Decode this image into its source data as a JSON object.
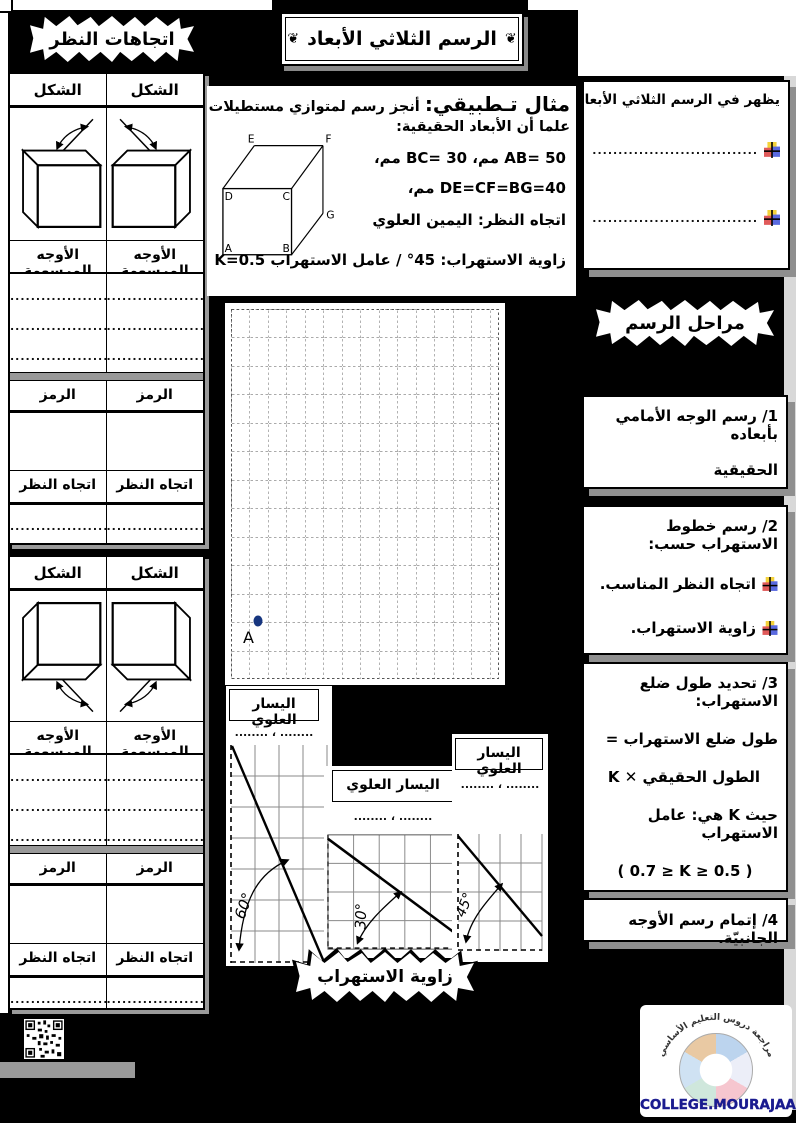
{
  "page": {
    "title": "الرسم الثلاثي الأبعاد",
    "ornament": "❦"
  },
  "view_directions": {
    "header": "اتجاهات النظر",
    "shape_header": "الشكل",
    "faces_header": "الأوجه المرسومة",
    "symbol_header": "الرمز",
    "view_header": "اتجاه النظر",
    "dots_line": "......................",
    "dots_short": "......................"
  },
  "example": {
    "title": "مثال تـطبيقي:",
    "intro": "أنجز رسم لمتوازي مستطيلات علما أن الأبعاد الحقيقية:",
    "dims_line1": "AB= 50 مم، BC= 30 مم،",
    "dims_line2": "DE=CF=BG=40 مم،",
    "view_line": "اتجاه النظر: اليمين العلوي",
    "angle_line": "زاوية الاستهراب: 45° / عامل الاستهراب K=0.5",
    "cube": {
      "a": "A",
      "b": "B",
      "c": "C",
      "d": "D",
      "e": "E",
      "f": "F",
      "g": "G"
    },
    "grid_point": "A"
  },
  "appear_box": {
    "title": "يظهر في الرسم الثلاثي الأبعاد",
    "items": [
      "....................................",
      "...................................."
    ]
  },
  "stages": {
    "header": "مراحل الرسم",
    "step1_line1": "1/ رسم الوجه الأمامي بأبعاده",
    "step1_line2": "الحقيقية",
    "step2_title": "2/ رسم خطوط الاستهراب حسب:",
    "step2_items": [
      "اتجاه النظر المناسب.",
      "زاوية الاستهراب."
    ],
    "step3_line1": "3/ تحديد طول ضلع الاستهراب:",
    "step3_line2": "طول ضلع الاستهراب =",
    "step3_line3": "الطول الحقيقي ✕ K",
    "step3_line4": "حيث K هي: عامل الاستهراب",
    "step3_line5": "( 0.7 ≥ K ≥ 0.5 )",
    "step4": "4/ إتمام رسم الأوجه الجانبيّة."
  },
  "angle_section": {
    "header": "زاوية الاستهراب",
    "diagrams": [
      {
        "label": "اليسار العلوي",
        "dots": "........ ، ........",
        "angle": "60°"
      },
      {
        "label": "اليسار العلوي",
        "dots": "........ ، ........",
        "angle": "30°"
      },
      {
        "label": "اليسار العلوي",
        "dots": "........ ، ........",
        "angle": "45°"
      }
    ]
  },
  "footer": {
    "arc_text": "موقع مراجعة دروس التعليم الأساسي",
    "site": "COLLEGE.MOURAJAA.COM"
  }
}
